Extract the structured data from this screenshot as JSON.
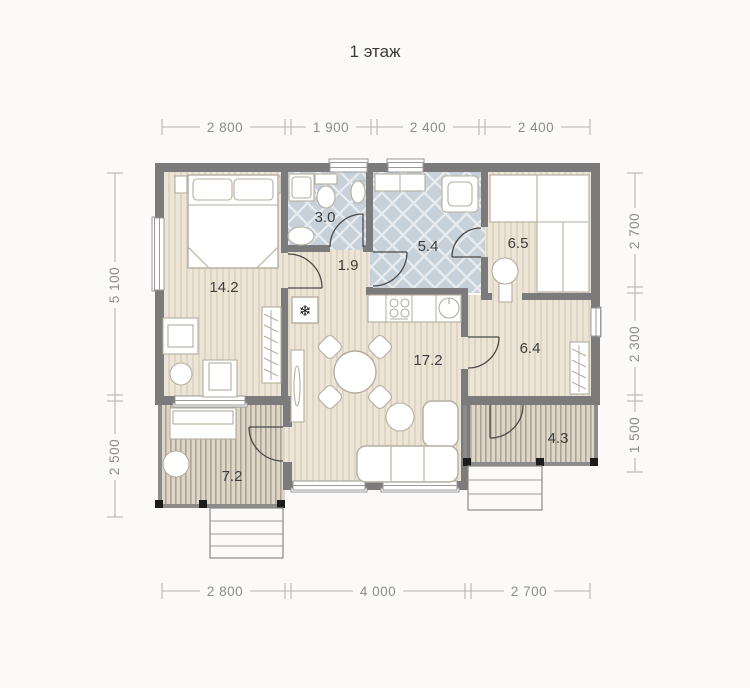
{
  "title": "1 этаж",
  "colors": {
    "wall": "#7b7b7b",
    "floor_wood": "#ece5d7",
    "floor_wood_stripe": "#ded6c3",
    "floor_tile": "#c6d1d9",
    "floor_tile_line": "#e9edf0",
    "deck": "#dcd5c8",
    "deck_stripe": "#aca394",
    "dimension_text": "#8d8d8d",
    "label_text": "#3d3d3d",
    "background": "#fbfaf9"
  },
  "icons": {
    "fridge": "❄"
  },
  "rooms": {
    "bedroom": {
      "area": "14.2"
    },
    "bathroom_small": {
      "area": "3.0"
    },
    "hallway": {
      "area": "1.9"
    },
    "bathroom_large": {
      "area": "5.4"
    },
    "storage": {
      "area": "6.5"
    },
    "entrance_hall": {
      "area": "6.4"
    },
    "living_kitchen": {
      "area": "17.2"
    },
    "terrace_left": {
      "area": "7.2"
    },
    "terrace_right": {
      "area": "4.3"
    }
  },
  "dimensions": {
    "top": [
      "2 800",
      "1 900",
      "2 400",
      "2 400"
    ],
    "bottom": [
      "2 800",
      "4 000",
      "2 700"
    ],
    "left": [
      "5 100",
      "2 500"
    ],
    "right": [
      "2 700",
      "2 300",
      "1 500"
    ]
  }
}
